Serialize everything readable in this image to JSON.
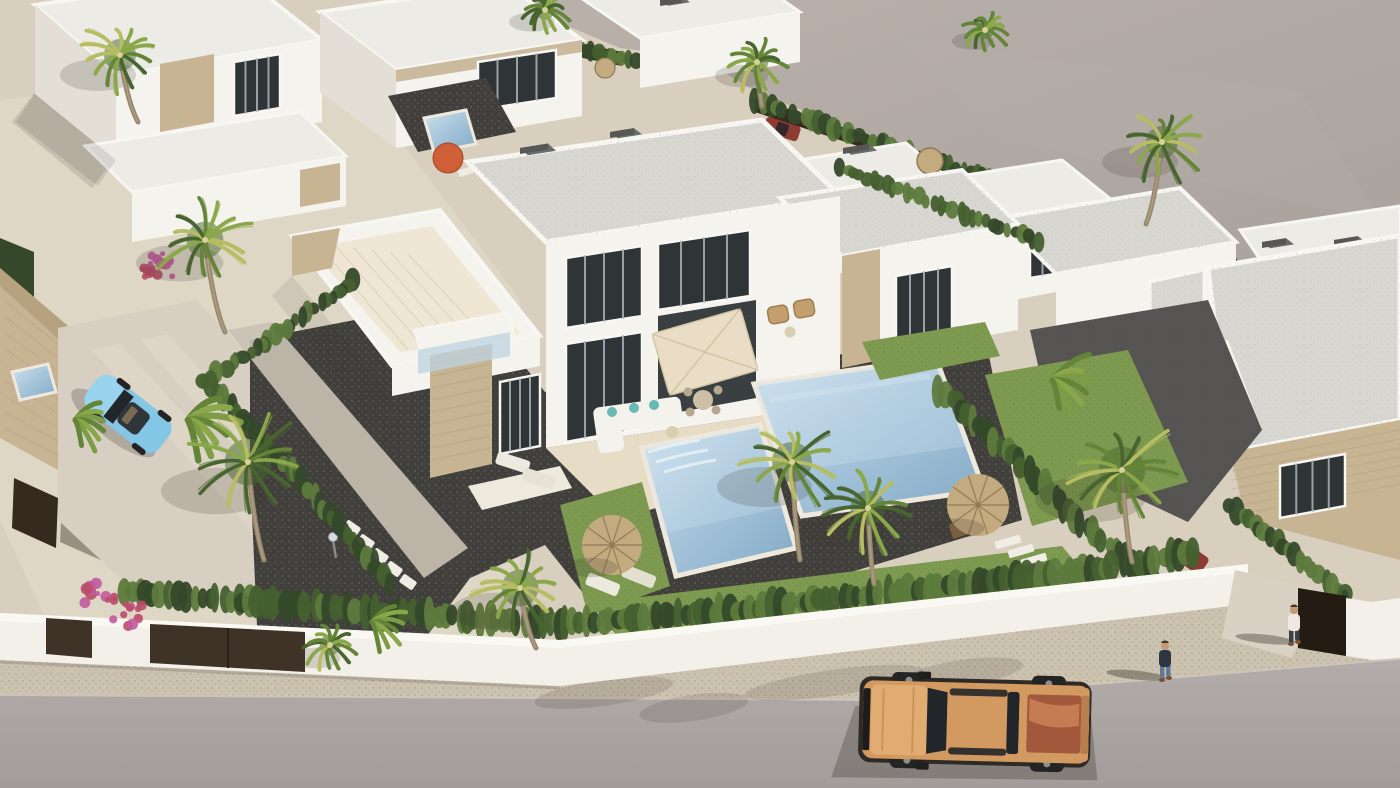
{
  "scene": {
    "type": "3d-architectural-render",
    "description": "Aerial 3D render of a modern Mediterranean villa development: white flat-roof villas with travertine stone accents, private gravel gardens with lawns and mosaic swimming pools, cypress hedges, palm trees, straw parasols, a white perimeter wall with brown gates, and a street with a copper pickup truck and pedestrians.",
    "camera": "high-angle aerial, diagonal composition",
    "lighting": "bright midday sun, shadows cast to the lower-left"
  },
  "objects": {
    "villas": {
      "count": 12,
      "style": "modern white flat-roof with travertine stone accent panels"
    },
    "pools": [
      {
        "location": "central-left garden",
        "finish": "light blue mosaic with steps"
      },
      {
        "location": "central-right garden",
        "finish": "light blue mosaic, long rectangle"
      },
      {
        "location": "rear garden",
        "finish": "small plunge pool"
      },
      {
        "location": "far-left property",
        "finish": "partially visible corner"
      }
    ],
    "vehicles": [
      {
        "kind": "pickup-truck",
        "color": "copper-orange",
        "location": "street, bottom center"
      },
      {
        "kind": "convertible",
        "color": "light-blue",
        "location": "left driveway"
      },
      {
        "kind": "suv",
        "color": "dark-red",
        "location": "right driveway behind hedge"
      },
      {
        "kind": "car",
        "color": "gray",
        "location": "rear open lot"
      },
      {
        "kind": "car",
        "color": "red",
        "location": "rear open lot"
      }
    ],
    "people": [
      {
        "appearance": "dark jacket, blue jeans",
        "activity": "walking on the sidewalk"
      },
      {
        "appearance": "white top, dark trousers",
        "activity": "standing at the right gate entrance"
      }
    ],
    "vegetation": {
      "palm_trees": 10,
      "cypress_hedges": "along property boundaries and street wall",
      "bougainvillea": "pink and purple clusters",
      "banana_plants": true,
      "lawns": true
    },
    "amenities": {
      "straw_parasols": 4,
      "orange_parasol": 1,
      "cream_patio_parasol": 1,
      "sun_loungers": true,
      "outdoor_sofa": "white with teal cushions",
      "picnic_table": true,
      "stepping_stones": true,
      "garden_lamp": true
    },
    "street": {
      "road": "light gray asphalt",
      "sidewalk": "beige aggregate",
      "perimeter_wall": "white rendered wall with brown gates"
    }
  },
  "palette": {
    "sand": "#d8cfbe",
    "sand_light": "#e4dccb",
    "ground_open": "#a9a19c",
    "ground_open_light": "#b9b1aa",
    "road": "#b2acaa",
    "road_dark": "#a29c9a",
    "sidewalk": "#cbc2b0",
    "curb": "#d8d0c0",
    "wall_white": "#f3f0ea",
    "wall_shade": "#e1ddd4",
    "wall_top": "#faf8f2",
    "roof_slab": "#d8d6d1",
    "roof_white": "#ecebe6",
    "roof_edge": "#f7f6f2",
    "face_lit": "#f5f3ee",
    "face_shade": "#e3dfd7",
    "face_dark": "#cdc8c0",
    "stone": "#c7b493",
    "stone_dark": "#a99470",
    "glass": "#2f3437",
    "frame": "#f8f7f4",
    "curtain": "#b7bcc2",
    "hedge_dark": "#35492a",
    "hedge_mid": "#46602f",
    "hedge_light": "#5d7a3d",
    "lawn": "#7d9a50",
    "lawn_light": "#93ad5c",
    "gravel": "#413f3c",
    "gravel_light": "#595650",
    "pool": "#a4c4da",
    "pool_light": "#cfe2ee",
    "pool_deep": "#84aac6",
    "coping": "#efe9dd",
    "palm_dark": "#48652f",
    "palm_mid": "#648438",
    "palm_light": "#8aa84a",
    "palm_yellow": "#b6bd62",
    "trunk": "#97876d",
    "straw": "#c3ab7f",
    "straw_dark": "#8f7a55",
    "parasol_orange": "#cf5f36",
    "parasol_cream": "#e9dec5",
    "truck_body": "#d29a60",
    "truck_hood": "#e0ac72",
    "truck_bed": "#a2583a",
    "truck_bed_hi": "#cf855a",
    "vehicle_glass": "#22262a",
    "tire": "#242424",
    "car_blue": "#84c6e6",
    "car_blue_dark": "#5fa9cf",
    "car_red": "#8e3b33",
    "gate_brown": "#3f3226",
    "fence_brown": "#36291d",
    "skin": "#c29a77",
    "shirt_dark": "#2e3642",
    "jeans": "#607a97",
    "shirt_white": "#efe8e2",
    "shadow": "#3c352e",
    "flower_pink": "#c25a9b",
    "flower_red": "#b94d68",
    "deck_tile": "#e7ddc6",
    "tile_light": "#efe7d4"
  }
}
